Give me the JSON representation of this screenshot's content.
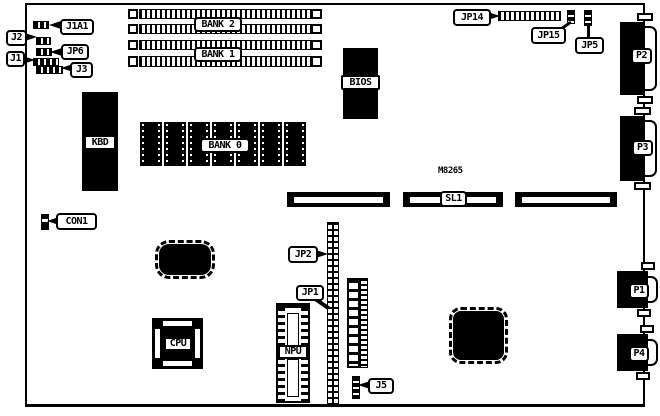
{
  "figure": {
    "kind": "motherboard layout diagram",
    "model_text": "M8265",
    "colors": {
      "ink": "#000000",
      "paper": "#ffffff"
    }
  },
  "labels": {
    "j1a1": "J1A1",
    "j2": "J2",
    "jp6": "JP6",
    "j1": "J1",
    "j3": "J3",
    "bank2": "BANK 2",
    "bank1": "BANK 1",
    "bank0": "BANK 0",
    "bios": "BIOS",
    "kbd": "KBD",
    "con1": "CON1",
    "jp14": "JP14",
    "jp15": "JP15",
    "jp5": "JP5",
    "p1": "P1",
    "p2": "P2",
    "p3": "P3",
    "p4": "P4",
    "sl1": "SL1",
    "jp2": "JP2",
    "jp1": "JP1",
    "cpu": "CPU",
    "npu": "NPU",
    "j5": "J5"
  }
}
